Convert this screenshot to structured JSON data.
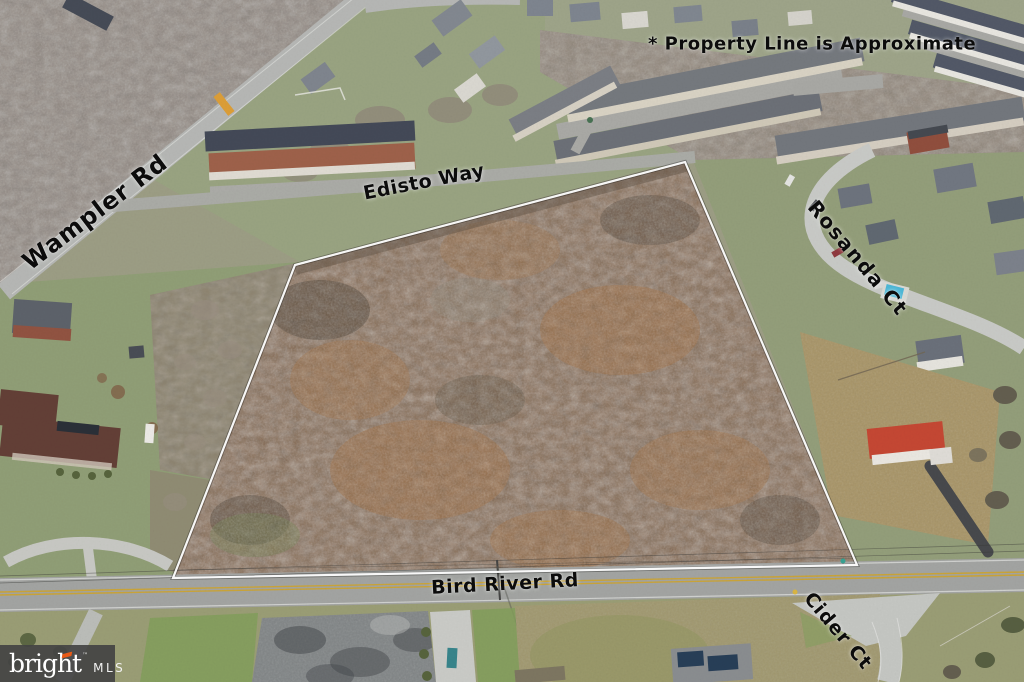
{
  "annotation": {
    "property_line_note": "* Property Line is Approximate"
  },
  "road_labels": {
    "wampler": "Wampler Rd",
    "edisto": "Edisto Way",
    "rosanda": "Rosanda Ct",
    "bird_river": "Bird River Rd",
    "cider": "Cider Ct"
  },
  "watermark": {
    "brand": "bright",
    "trademark": "™",
    "suffix": "MLS"
  },
  "colors": {
    "property_boundary": "#ffffff",
    "label_text": "#0c0c0c",
    "watermark_background": "#474747",
    "watermark_accent": "#e85a17",
    "road_center_line": "#c9a12f",
    "pool": "#45b5d6",
    "parcel_ground": "#7d5e44"
  }
}
